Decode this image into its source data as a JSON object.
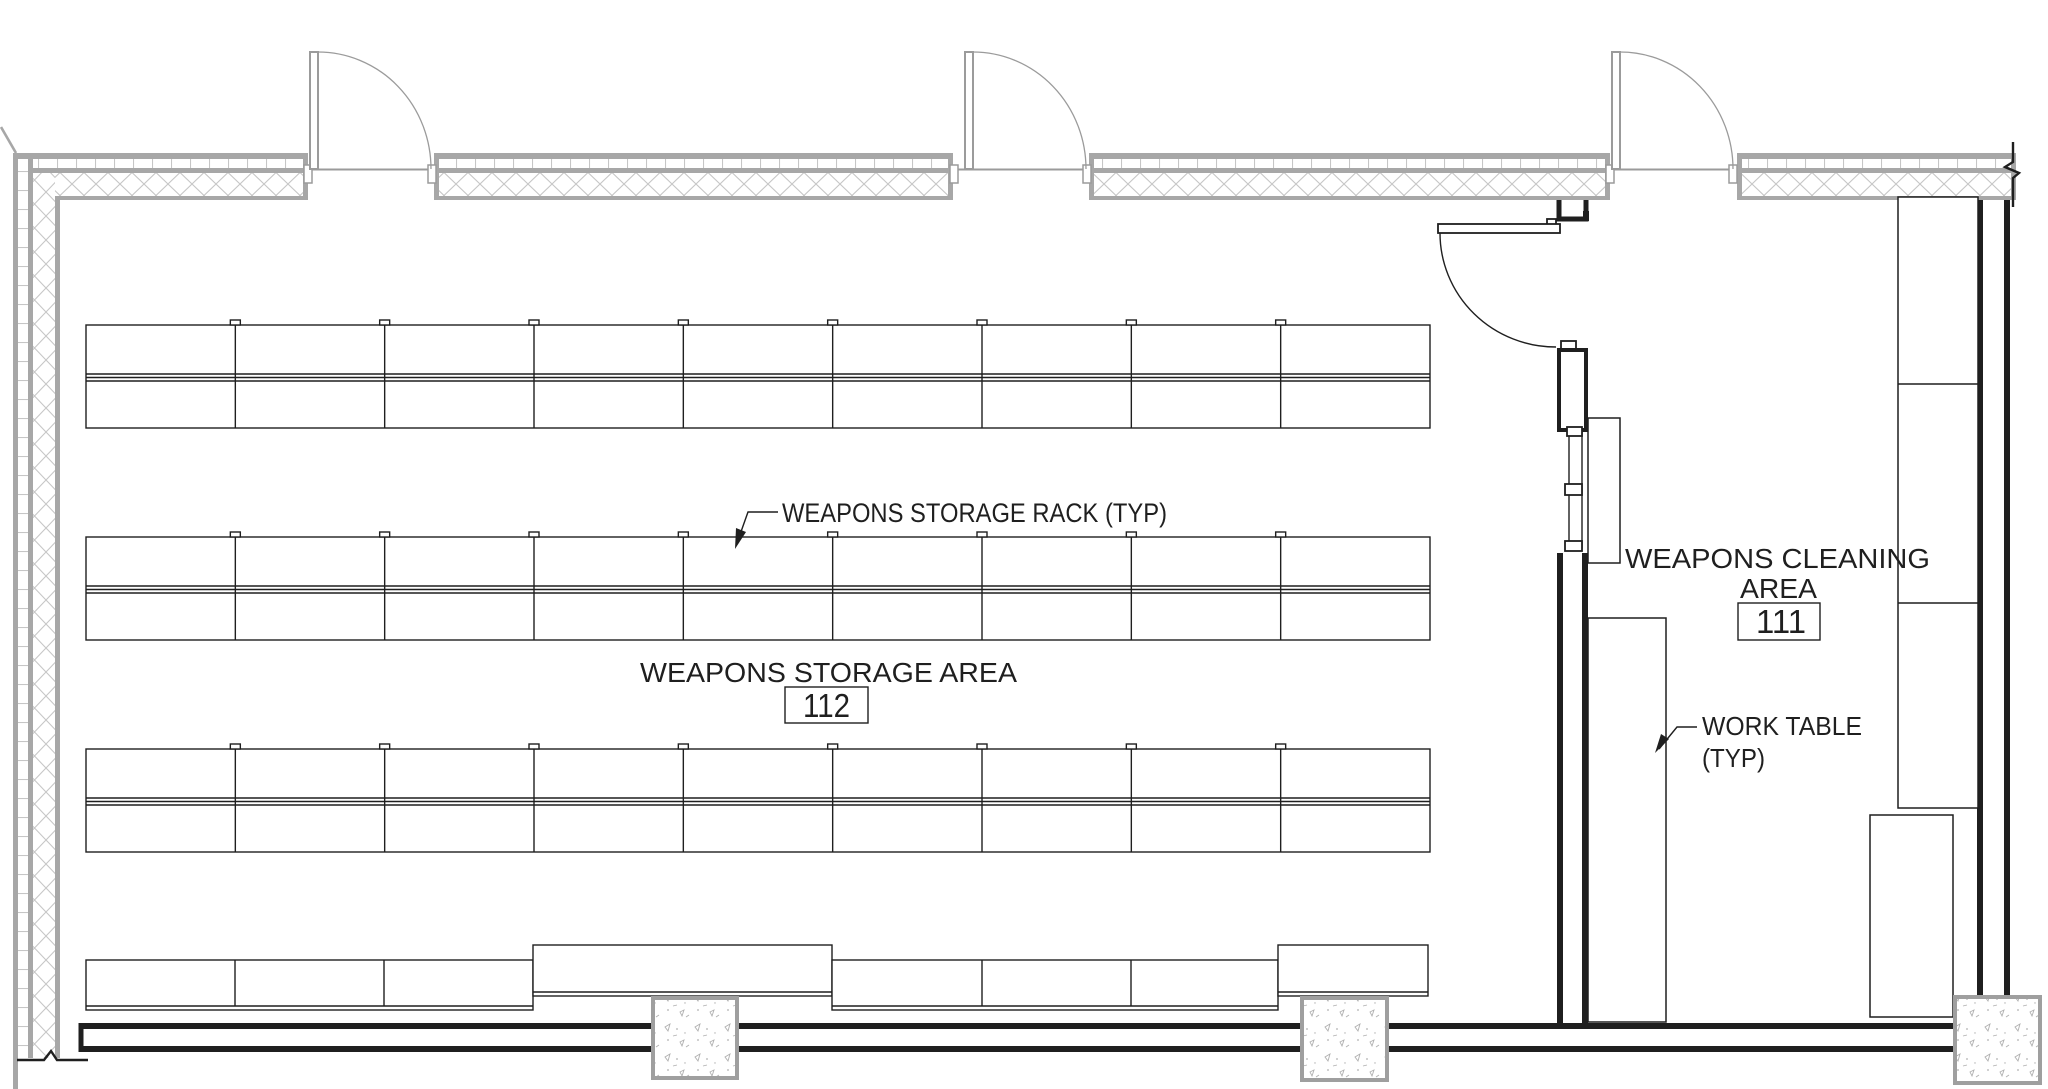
{
  "colors": {
    "line": "#1f1f1f",
    "wall_gray": "#a7a7a7",
    "hatch_gray": "#c6c6c6",
    "door_gray": "#9b9b9b",
    "column_gray": "#9f9f9f",
    "stipple_gray": "#b0b0b0",
    "background": "#ffffff"
  },
  "labels": {
    "rack_callout": "WEAPONS STORAGE RACK (TYP)",
    "storage_room": {
      "name": "WEAPONS STORAGE AREA",
      "number": "112"
    },
    "cleaning_room": {
      "name_line1": "WEAPONS CLEANING",
      "name_line2": "AREA",
      "number": "111"
    },
    "work_table_callout_line1": "WORK TABLE",
    "work_table_callout_line2": "(TYP)"
  },
  "racks": {
    "x_start": 86,
    "x_end": 1430,
    "bays": 9,
    "double_rows_y": [
      325,
      537,
      749
    ],
    "row_height": 103,
    "shelf_lines": [
      49,
      52.5,
      56
    ],
    "tick_width": 10,
    "tick_height": 5,
    "bottom_row": {
      "segments": [
        {
          "x1": 86,
          "x2": 533,
          "y": 960,
          "h": 50,
          "divs": [
            235,
            384
          ]
        },
        {
          "x1": 533,
          "x2": 832,
          "y": 945,
          "h": 51,
          "divs": []
        },
        {
          "x1": 832,
          "x2": 1278,
          "y": 960,
          "h": 50,
          "divs": [
            982,
            1131
          ]
        },
        {
          "x1": 1278,
          "x2": 1428,
          "y": 945,
          "h": 51,
          "divs": []
        }
      ]
    }
  }
}
